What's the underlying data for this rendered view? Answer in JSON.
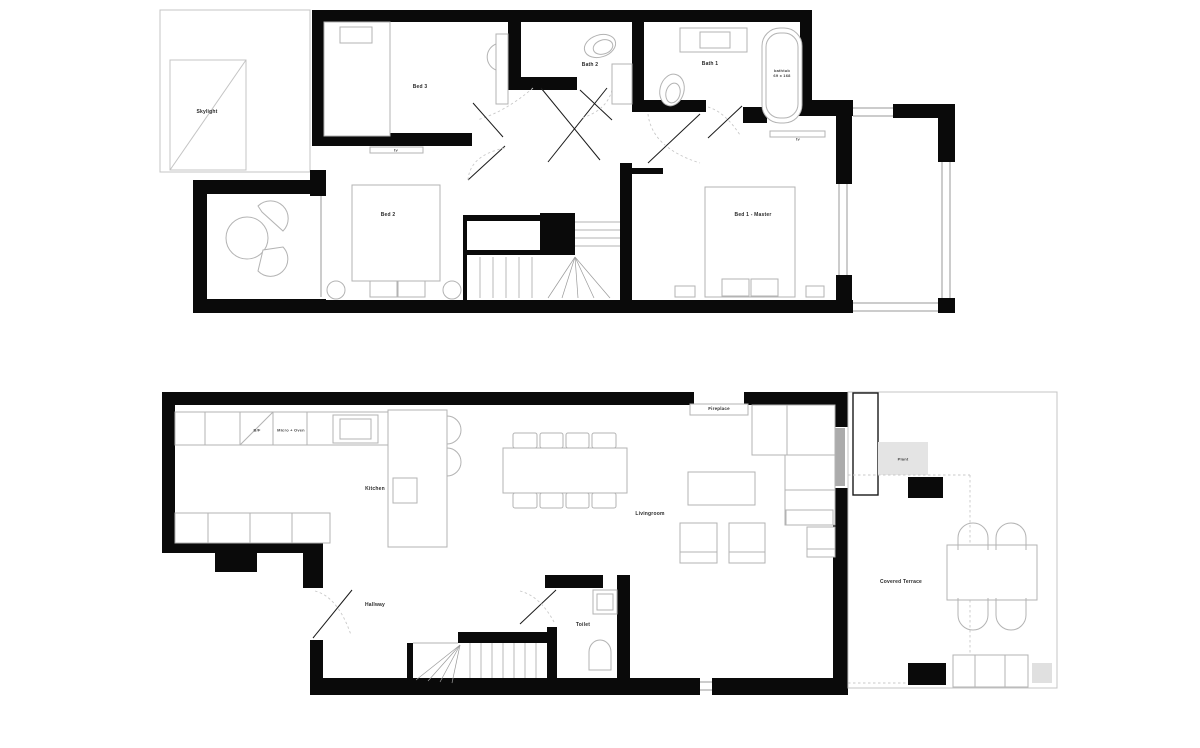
{
  "plans": {
    "upper_floor": {
      "rooms": {
        "skylight": "Skylight",
        "bed3": "Bed 3",
        "bath2": "Bath 2",
        "bath1": "Bath 1",
        "bed2": "Bed 2",
        "bed1_master": "Bed 1 - Master"
      },
      "fixtures": {
        "bathtub_name": "bathtub",
        "bathtub_size": "69 x 168",
        "tv_bed2": "tv",
        "tv_master": "tv"
      }
    },
    "ground_floor": {
      "rooms": {
        "kitchen": "Kitchen",
        "hallway": "Hallway",
        "toilet": "Toilet",
        "livingroom": "Livingroom",
        "covered_terrace": "Covered Terrace"
      },
      "fixtures": {
        "bf": "B/F",
        "micro_oven": "Micro + Oven",
        "fireplace": "Fireplace",
        "plant": "Plant"
      }
    }
  },
  "colors": {
    "wall": "#0a0a0a",
    "furniture_line": "#b3b3b3",
    "glass_door": "#ababab",
    "plant_fill": "#e4e4e4"
  }
}
